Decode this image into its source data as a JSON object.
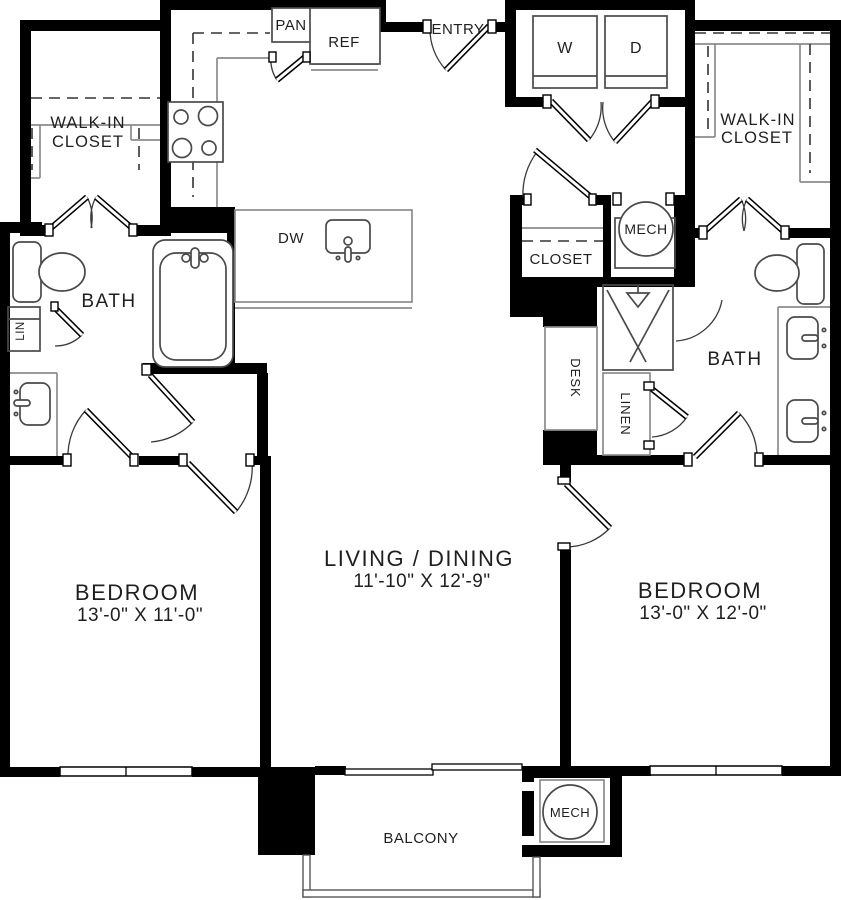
{
  "plan": {
    "rooms": {
      "walk_in_closet_left": {
        "label_line1": "WALK-IN",
        "label_line2": "CLOSET"
      },
      "walk_in_closet_right": {
        "label_line1": "WALK-IN",
        "label_line2": "CLOSET"
      },
      "entry": {
        "label": "ENTRY"
      },
      "laundry": {
        "washer_label": "W",
        "dryer_label": "D"
      },
      "closet": {
        "label": "CLOSET"
      },
      "mech_upper": {
        "label": "MECH"
      },
      "bath_left": {
        "label": "BATH"
      },
      "linen_cabinet_left": {
        "label": "LIN"
      },
      "desk_nook": {
        "label": "DESK"
      },
      "linen_closet_right": {
        "label": "LINEN"
      },
      "bath_right": {
        "label": "BATH"
      },
      "bedroom_left": {
        "label": "BEDROOM",
        "dimensions": "13'-0\" X 11'-0\""
      },
      "living_dining": {
        "label": "LIVING / DINING",
        "dimensions": "11'-10\" X 12'-9\""
      },
      "bedroom_right": {
        "label": "BEDROOM",
        "dimensions": "13'-0\" X 12'-0\""
      },
      "balcony": {
        "label": "BALCONY"
      },
      "mech_lower": {
        "label": "MECH"
      }
    },
    "kitchen": {
      "pantry_label": "PAN",
      "refrigerator_label": "REF",
      "dishwasher_label": "DW"
    },
    "fixtures": [
      "stove-4-burner",
      "island-sink",
      "bathtub",
      "toilet",
      "vanity-sink",
      "shower",
      "double-vanity",
      "washer",
      "dryer",
      "water-heater"
    ],
    "colors": {
      "wall": "#000000",
      "cabinetry_line": "#8c8c8c",
      "fixture_line": "#4a4a4a",
      "text": "#1f1f1f",
      "background": "#ffffff"
    }
  }
}
